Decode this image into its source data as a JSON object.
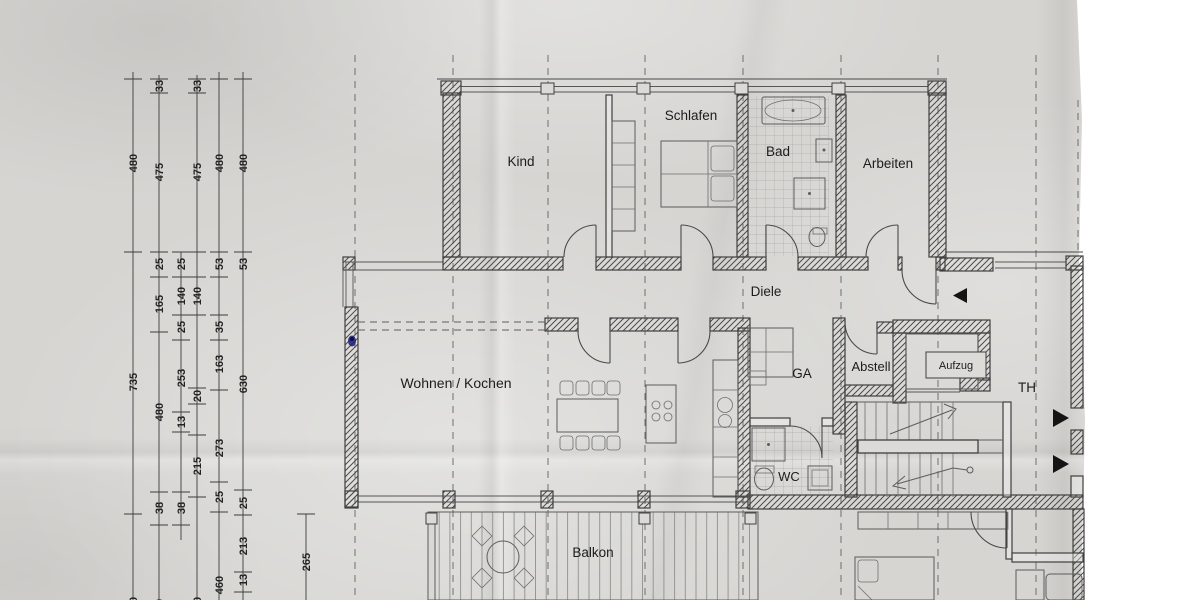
{
  "photo": {
    "background": "#ffffff",
    "paper_color": "#d6d5d2",
    "ink_mark_color": "#232384"
  },
  "rooms": [
    {
      "id": "kind",
      "label": "Kind",
      "x": 521,
      "y": 166,
      "size": 13.5
    },
    {
      "id": "schlafen",
      "label": "Schlafen",
      "x": 691,
      "y": 120,
      "size": 13.5
    },
    {
      "id": "bad",
      "label": "Bad",
      "x": 778,
      "y": 156,
      "size": 13.5
    },
    {
      "id": "arbeiten",
      "label": "Arbeiten",
      "x": 888,
      "y": 168,
      "size": 13.5
    },
    {
      "id": "diele",
      "label": "Diele",
      "x": 766,
      "y": 296,
      "size": 13.5
    },
    {
      "id": "wohnen",
      "label": "Wohnen / Kochen",
      "x": 456,
      "y": 388,
      "size": 14
    },
    {
      "id": "ga",
      "label": "GA",
      "x": 802,
      "y": 378,
      "size": 13.5
    },
    {
      "id": "abstell",
      "label": "Abstell",
      "x": 871,
      "y": 371,
      "size": 13
    },
    {
      "id": "aufzug",
      "label": "Aufzug",
      "x": 956,
      "y": 369,
      "size": 11
    },
    {
      "id": "th",
      "label": "TH",
      "x": 1027,
      "y": 392,
      "size": 13.5
    },
    {
      "id": "wc",
      "label": "WC",
      "x": 789,
      "y": 481,
      "size": 13
    },
    {
      "id": "balkon",
      "label": "Balkon",
      "x": 593,
      "y": 557,
      "size": 13.5
    }
  ],
  "dimension_chains": [
    {
      "x": 133,
      "y1": 72,
      "y2": 600,
      "ticks": [
        79,
        252,
        514
      ],
      "labels": [
        {
          "v": "480",
          "y": 163
        },
        {
          "v": "735",
          "y": 382
        },
        {
          "v": "480",
          "y": 606
        }
      ]
    },
    {
      "x": 159,
      "y1": 75,
      "y2": 600,
      "ticks": [
        79,
        93,
        252,
        277,
        332,
        492,
        525
      ],
      "labels": [
        {
          "v": "33",
          "y": 86
        },
        {
          "v": "475",
          "y": 172
        },
        {
          "v": "25",
          "y": 264
        },
        {
          "v": "165",
          "y": 304
        },
        {
          "v": "480",
          "y": 412
        },
        {
          "v": "38",
          "y": 508
        },
        {
          "v": "410",
          "y": 608
        }
      ]
    },
    {
      "x": 181,
      "y1": 252,
      "y2": 540,
      "ticks": [
        252,
        277,
        315,
        340,
        412,
        432,
        492,
        525
      ],
      "labels": [
        {
          "v": "25",
          "y": 264
        },
        {
          "v": "140",
          "y": 296
        },
        {
          "v": "25",
          "y": 327
        },
        {
          "v": "253",
          "y": 378
        },
        {
          "v": "13",
          "y": 422
        },
        {
          "v": "38",
          "y": 508
        }
      ]
    },
    {
      "x": 197,
      "y1": 75,
      "y2": 600,
      "ticks": [
        79,
        93,
        252,
        277,
        315,
        388,
        404,
        435,
        497
      ],
      "labels": [
        {
          "v": "33",
          "y": 86
        },
        {
          "v": "475",
          "y": 172
        },
        {
          "v": "140",
          "y": 296
        },
        {
          "v": "20",
          "y": 396
        },
        {
          "v": "215",
          "y": 466
        },
        {
          "v": "460",
          "y": 606
        }
      ]
    },
    {
      "x": 219,
      "y1": 72,
      "y2": 600,
      "ticks": [
        79,
        252,
        277,
        315,
        340,
        390,
        482,
        512
      ],
      "labels": [
        {
          "v": "480",
          "y": 163
        },
        {
          "v": "53",
          "y": 264
        },
        {
          "v": "35",
          "y": 327
        },
        {
          "v": "163",
          "y": 364
        },
        {
          "v": "273",
          "y": 448
        },
        {
          "v": "25",
          "y": 497
        },
        {
          "v": "460",
          "y": 585
        }
      ]
    },
    {
      "x": 243,
      "y1": 72,
      "y2": 600,
      "ticks": [
        79,
        252,
        490,
        515,
        572,
        592
      ],
      "labels": [
        {
          "v": "480",
          "y": 163
        },
        {
          "v": "53",
          "y": 264
        },
        {
          "v": "630",
          "y": 384
        },
        {
          "v": "25",
          "y": 503
        },
        {
          "v": "213",
          "y": 546
        },
        {
          "v": "13",
          "y": 580
        }
      ]
    },
    {
      "x": 306,
      "y1": 514,
      "y2": 600,
      "ticks": [
        514
      ],
      "labels": [
        {
          "v": "265",
          "y": 562
        }
      ]
    }
  ],
  "grid": {
    "x_lines": [
      355,
      453,
      548,
      645,
      743,
      841,
      938,
      1036
    ],
    "y_top": 55,
    "y_bottom": 600,
    "edge_line": {
      "x": 1078,
      "y1": 100,
      "y2": 250
    }
  }
}
